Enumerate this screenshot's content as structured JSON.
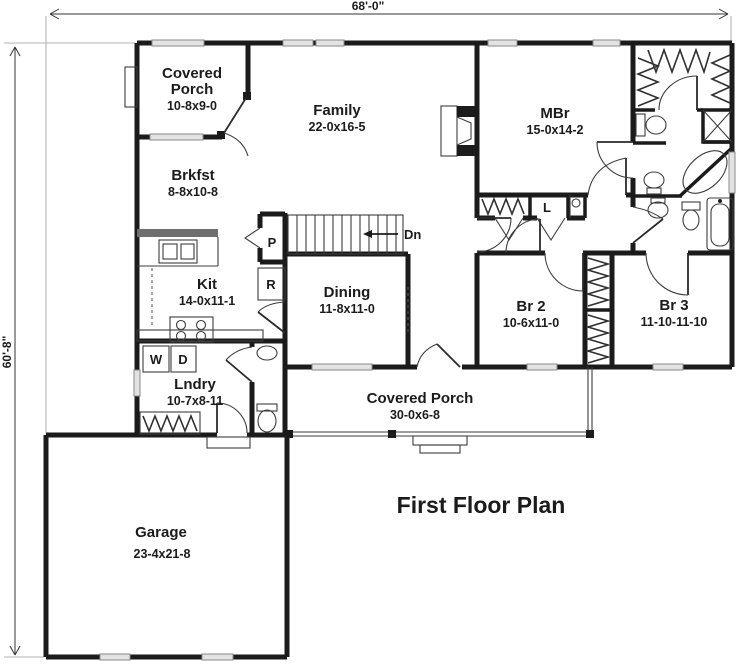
{
  "title": "First Floor Plan",
  "dimensions": {
    "overall_width": "68'-0\"",
    "overall_height": "60'-8\""
  },
  "rooms": {
    "covered_porch_rear": {
      "line1": "Covered",
      "line2": "Porch",
      "size": "10-8x9-0"
    },
    "family": {
      "name": "Family",
      "size": "22-0x16-5"
    },
    "master_bedroom": {
      "name": "MBr",
      "size": "15-0x14-2"
    },
    "breakfast": {
      "name": "Brkfst",
      "size": "8-8x10-8"
    },
    "kitchen": {
      "name": "Kit",
      "size": "14-0x11-1"
    },
    "dining": {
      "name": "Dining",
      "size": "11-8x11-0"
    },
    "bedroom2": {
      "name": "Br 2",
      "size": "10-6x11-0"
    },
    "bedroom3": {
      "name": "Br 3",
      "size": "11-10-11-10"
    },
    "laundry": {
      "name": "Lndry",
      "size": "10-7x8-11"
    },
    "covered_porch_front": {
      "name": "Covered Porch",
      "size": "30-0x6-8"
    },
    "garage": {
      "name": "Garage",
      "size": "23-4x21-8"
    }
  },
  "markers": {
    "stairs_down": "Dn",
    "pantry": "P",
    "refrigerator": "R",
    "washer": "W",
    "dryer": "D",
    "linen": "L"
  },
  "colors": {
    "wall": "#1b1b1b",
    "thin_line": "#3c3c3c",
    "window_fill": "#e3e3e3",
    "window_stroke": "#888888",
    "background": "#ffffff"
  }
}
